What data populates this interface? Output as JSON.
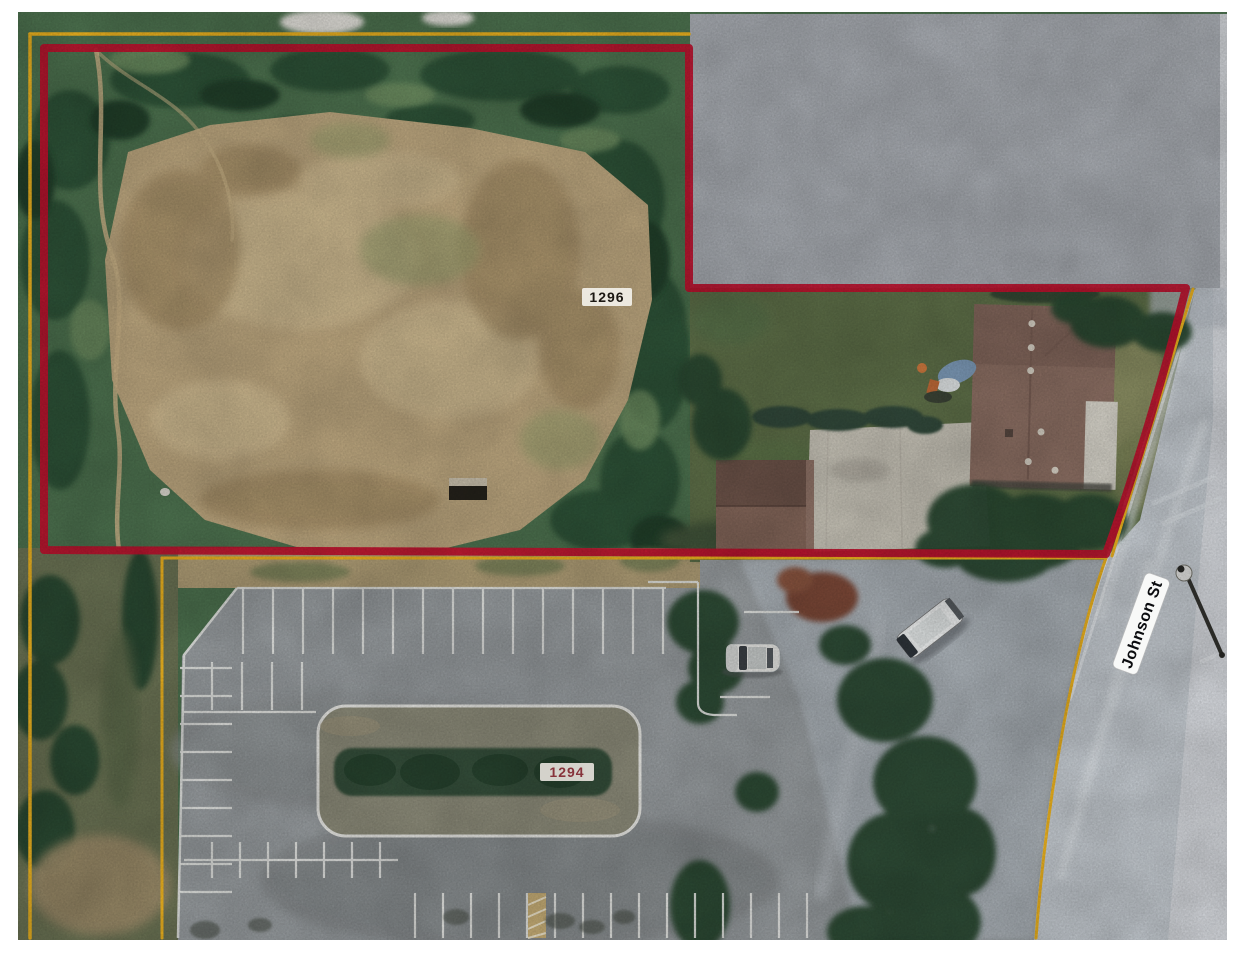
{
  "photo": {
    "type": "scanned-aerial-parcel-photo",
    "labels": {
      "parcel_upper": "1296",
      "parcel_lower": "1294",
      "street": "Johnson St"
    },
    "colors": {
      "boundary_red": "#c2112e",
      "boundary_yellow": "#edb320",
      "redaction_gray": "#a9adb3",
      "forest_green": "#4e7350",
      "clearing_tan": "#bfa981",
      "parking_gray": "#999ea1",
      "road_gray": "#c6ccd2",
      "page_margin": "#ffffff"
    }
  }
}
